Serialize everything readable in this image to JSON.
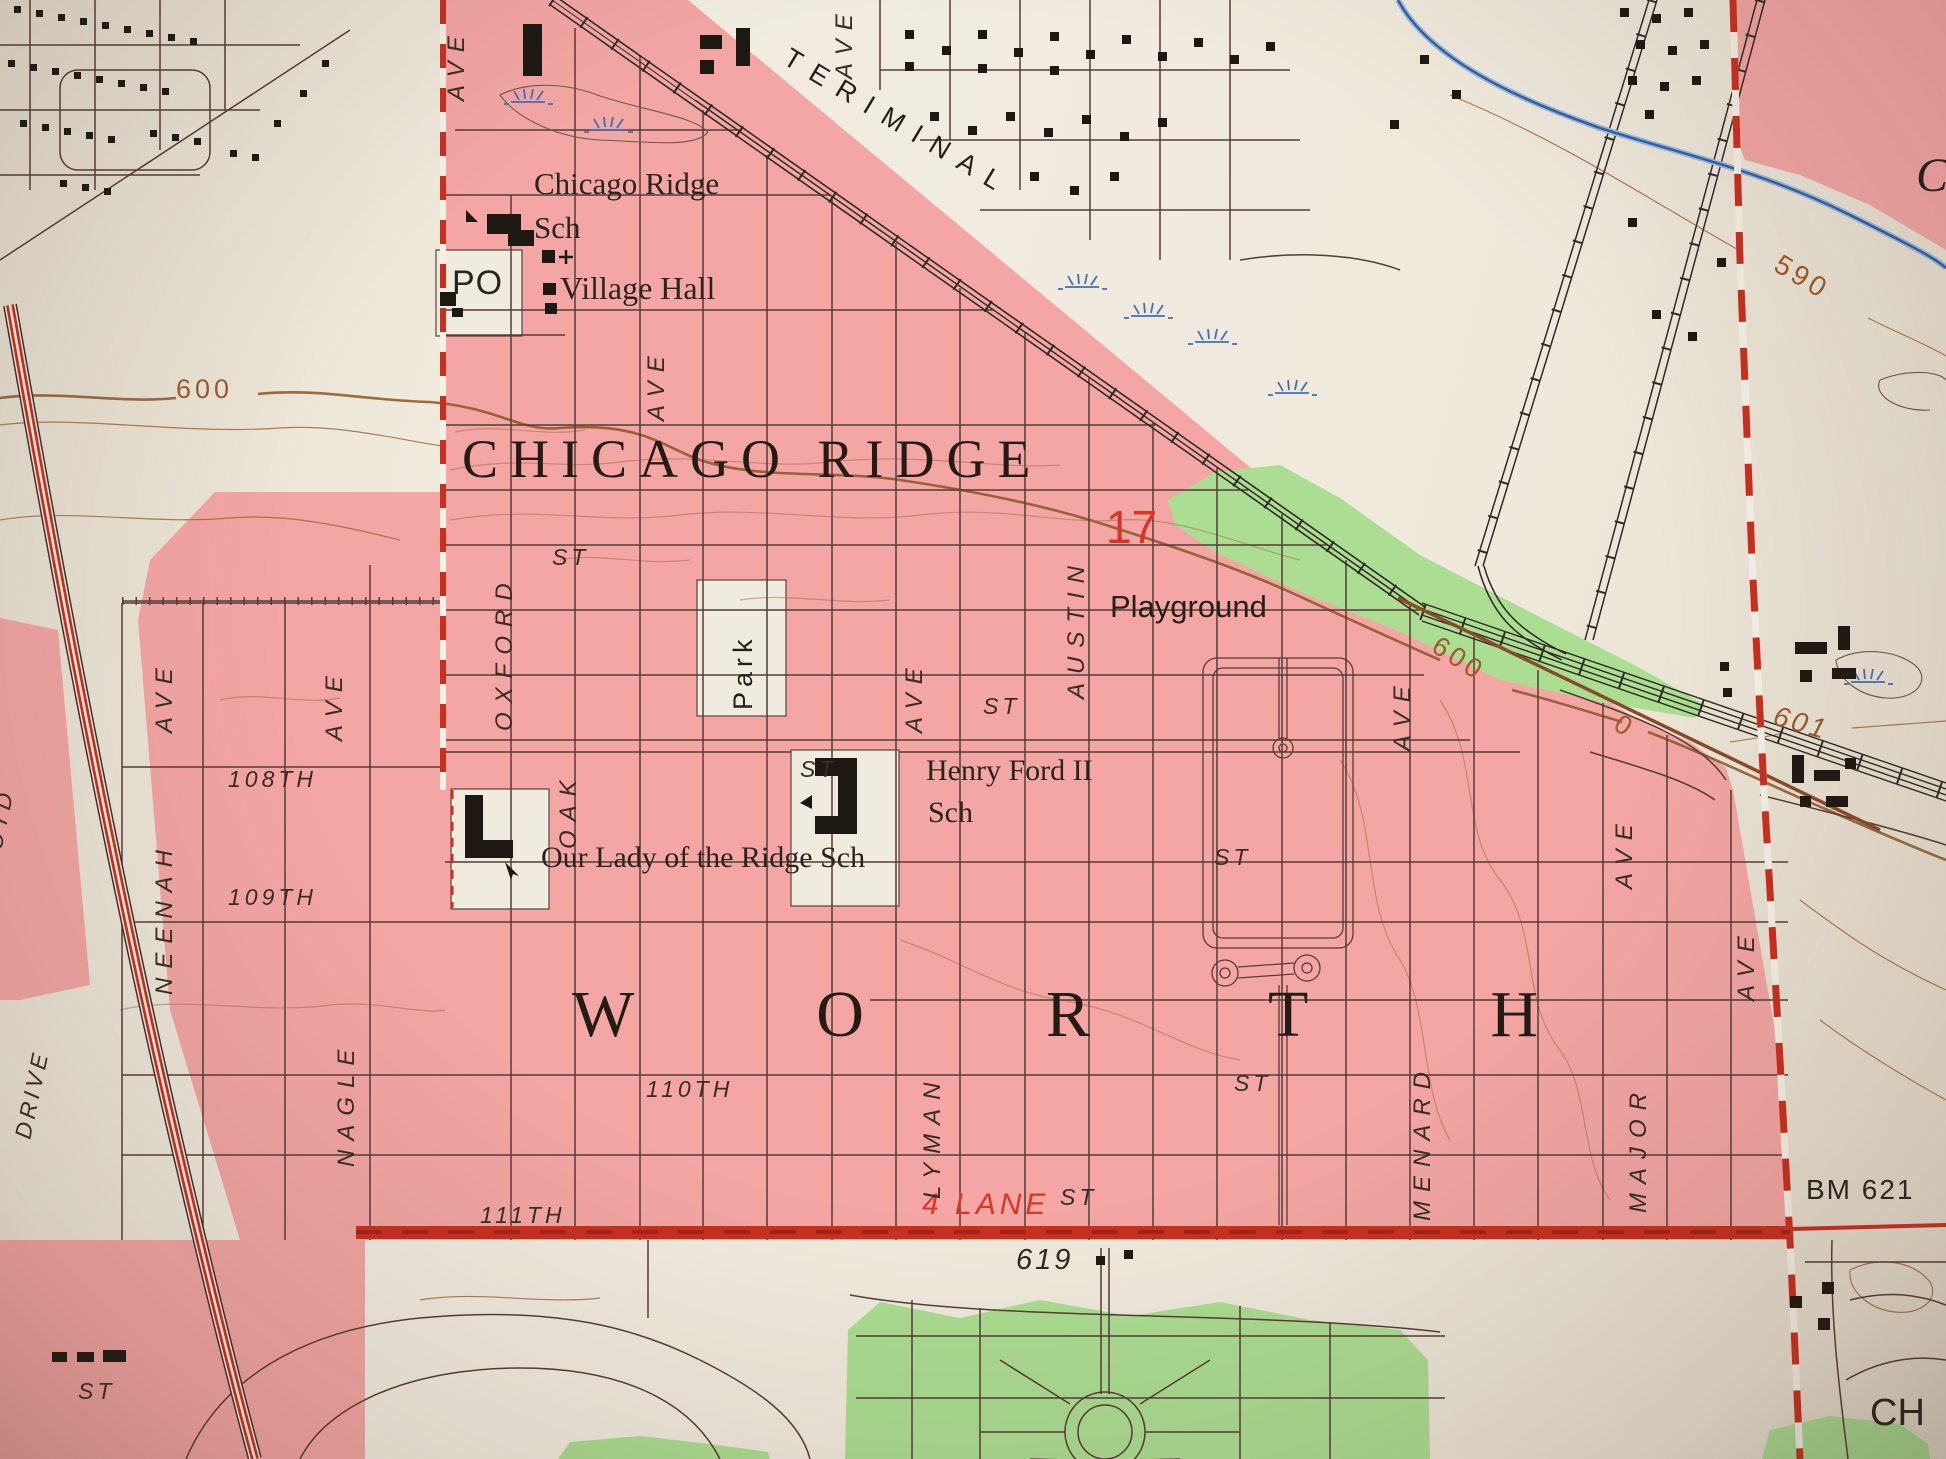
{
  "colors": {
    "urban_pink": "#f3a6a4",
    "paper": "#efe9dc",
    "road_red": "#c92f1f",
    "red_text": "#d93525",
    "contour_brown": "#9c5b2b",
    "vegetation_green": "#abdd92",
    "water_blue": "#3f6fb5",
    "ink_black": "#1e1813"
  },
  "labels": [
    {
      "text": "TERIMINAL",
      "kind": "railroad-name"
    },
    {
      "text": "Chicago Ridge",
      "kind": "feature"
    },
    {
      "text": "Sch",
      "kind": "feature"
    },
    {
      "text": "PO",
      "kind": "feature"
    },
    {
      "text": "Village Hall",
      "kind": "feature"
    },
    {
      "text": "CHICAGO RIDGE",
      "kind": "municipality"
    },
    {
      "text": "17",
      "kind": "route-number"
    },
    {
      "text": "Playground",
      "kind": "feature"
    },
    {
      "text": "Henry Ford II",
      "kind": "feature"
    },
    {
      "text": "Sch",
      "kind": "feature"
    },
    {
      "text": "Our Lady of the Ridge Sch",
      "kind": "feature"
    },
    {
      "text": "WORTH",
      "kind": "municipality"
    },
    {
      "text": "108TH",
      "kind": "street"
    },
    {
      "text": "109TH",
      "kind": "street"
    },
    {
      "text": "110TH",
      "kind": "street"
    },
    {
      "text": "111TH",
      "kind": "street"
    },
    {
      "text": "4 LANE",
      "kind": "road-note"
    },
    {
      "text": "619",
      "kind": "spot-elevation"
    },
    {
      "text": "BM 621",
      "kind": "benchmark"
    },
    {
      "text": "CH",
      "kind": "partial-label"
    },
    {
      "text": "ST",
      "kind": "street"
    },
    {
      "text": "ST",
      "kind": "street"
    },
    {
      "text": "ST",
      "kind": "street"
    },
    {
      "text": "ST",
      "kind": "street"
    },
    {
      "text": "ST",
      "kind": "street"
    },
    {
      "text": "ST",
      "kind": "street"
    },
    {
      "text": "ST",
      "kind": "street"
    },
    {
      "text": "600",
      "kind": "contour"
    },
    {
      "text": "600",
      "kind": "contour"
    },
    {
      "text": "0",
      "kind": "contour"
    },
    {
      "text": "601",
      "kind": "contour"
    },
    {
      "text": "590",
      "kind": "contour"
    },
    {
      "text": "C",
      "kind": "partial-label"
    },
    {
      "text": "AVE",
      "kind": "street"
    },
    {
      "text": "AVE",
      "kind": "street"
    },
    {
      "text": "AVE",
      "kind": "street"
    },
    {
      "text": "AVE",
      "kind": "street"
    },
    {
      "text": "AVE",
      "kind": "street"
    },
    {
      "text": "AVE",
      "kind": "street"
    },
    {
      "text": "AVE",
      "kind": "street"
    },
    {
      "text": "AVE",
      "kind": "street"
    },
    {
      "text": "AVE",
      "kind": "street"
    },
    {
      "text": "OXFORD",
      "kind": "street"
    },
    {
      "text": "OAK",
      "kind": "street"
    },
    {
      "text": "AUSTIN",
      "kind": "street"
    },
    {
      "text": "LYMAN",
      "kind": "street"
    },
    {
      "text": "MENARD",
      "kind": "street"
    },
    {
      "text": "MAJOR",
      "kind": "street"
    },
    {
      "text": "NEENAH",
      "kind": "street"
    },
    {
      "text": "NAGLE",
      "kind": "street"
    },
    {
      "text": "LLOYD",
      "kind": "street"
    },
    {
      "text": "DRIVE",
      "kind": "street"
    },
    {
      "text": "Park",
      "kind": "feature"
    }
  ]
}
